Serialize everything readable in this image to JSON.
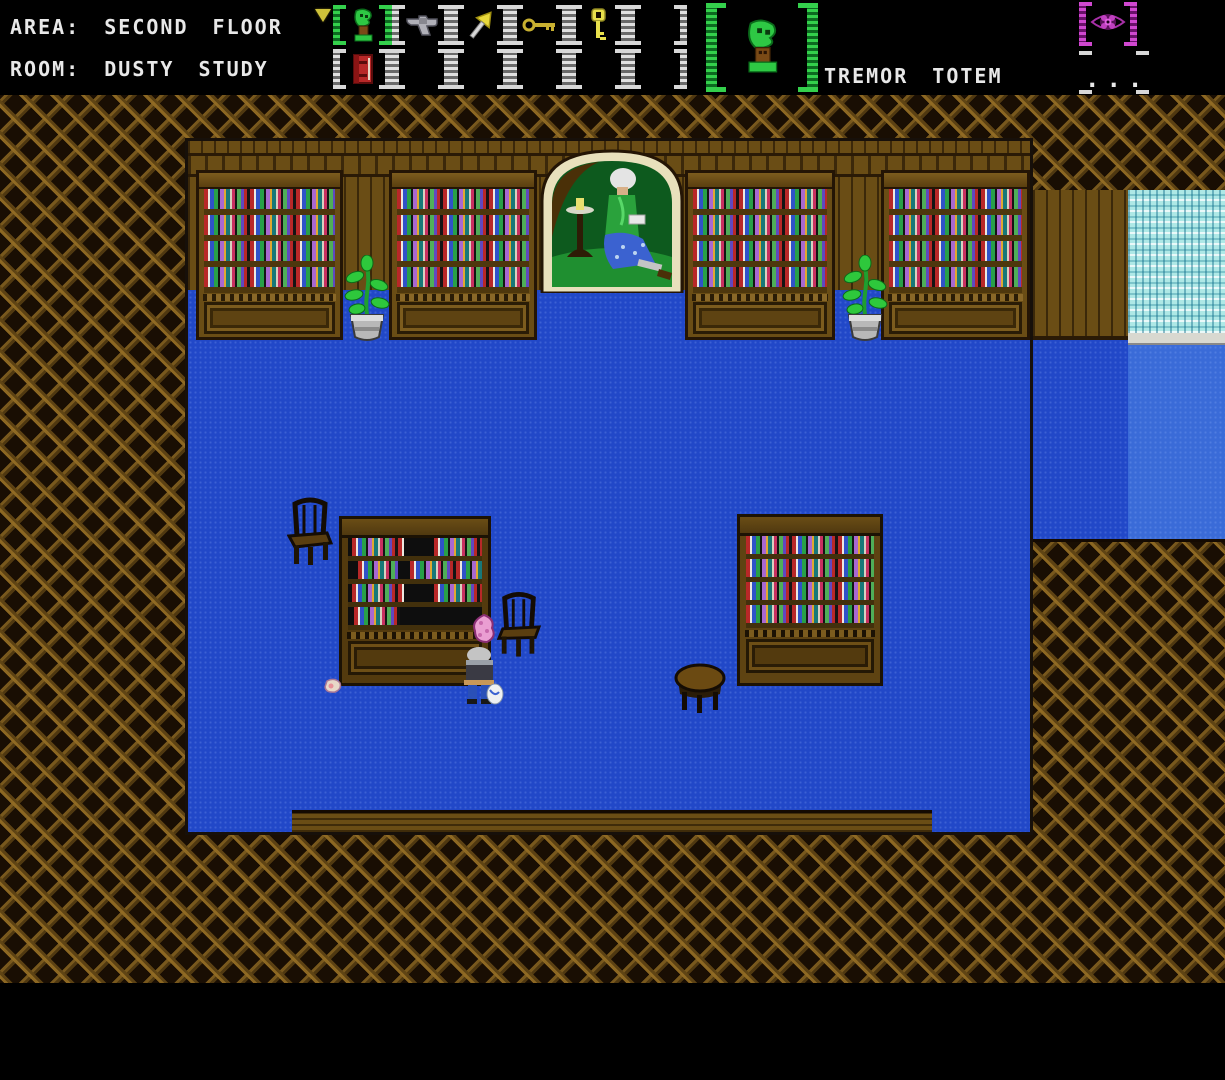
{
  "hud": {
    "area_line": "AREA: SECOND FLOOR",
    "room_line": "ROOM: DUSTY STUDY",
    "cursor_icon": "down-triangle-cursor-icon",
    "inventory": {
      "rows": 2,
      "cols": 6,
      "slots": [
        {
          "index": 1,
          "item": "tremor-totem",
          "icon": "tremor-totem-icon",
          "selected": true
        },
        {
          "index": 2,
          "item": "revolver",
          "icon": "revolver-icon",
          "selected": false
        },
        {
          "index": 3,
          "item": "duster",
          "icon": "duster-icon",
          "selected": false
        },
        {
          "index": 4,
          "item": "gold-key",
          "icon": "key-horizontal-icon",
          "selected": false
        },
        {
          "index": 5,
          "item": "skeleton-key",
          "icon": "key-vertical-icon",
          "selected": false
        },
        {
          "index": 6,
          "item": null,
          "selected": false
        },
        {
          "index": 7,
          "item": "red-book",
          "icon": "red-book-icon",
          "selected": false
        },
        {
          "index": 8,
          "item": null,
          "selected": false
        },
        {
          "index": 9,
          "item": null,
          "selected": false
        },
        {
          "index": 10,
          "item": null,
          "selected": false
        },
        {
          "index": 11,
          "item": null,
          "selected": false
        },
        {
          "index": 12,
          "item": null,
          "selected": false
        }
      ]
    },
    "selected_item": {
      "name": "TREMOR TOTEM",
      "icon": "tremor-totem-icon"
    },
    "indicators": {
      "eye_icon": "eye-indicator-icon",
      "ellipsis_label": "..."
    }
  },
  "scene": {
    "location": {
      "area": "SECOND FLOOR",
      "room": "DUSTY STUDY"
    },
    "objects": [
      "wall-bookcase-1",
      "wall-bookcase-2",
      "portrait-painting",
      "wall-bookcase-3",
      "wall-bookcase-4",
      "potted-plant-left",
      "potted-plant-right",
      "window-curtain",
      "chair-left",
      "freestanding-bookcase-left",
      "chair-right",
      "player-character",
      "pink-item",
      "dropped-item",
      "round-table",
      "freestanding-bookcase-right"
    ]
  },
  "colors": {
    "hud_text": "#e8e8e8",
    "selection_green": "#34d04c",
    "indicator_magenta": "#d048d0",
    "floor_blue": "#2148c8",
    "floor_light_blue": "#3a6bd8",
    "wood_brown": "#6a4d15",
    "weave_background": "#190e03",
    "curtain_teal": "#aee8e6"
  }
}
